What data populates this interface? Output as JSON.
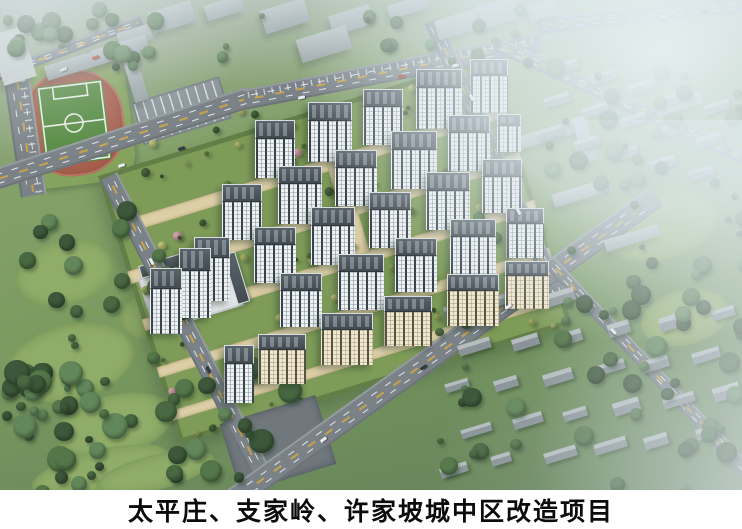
{
  "image": {
    "type": "aerial-architectural-rendering",
    "caption": "太平庄、支家岭、许家坡城中区改造项目"
  },
  "palette": {
    "caption_bg": "#ffffff",
    "caption_text": "#0b0b0b",
    "asphalt": "#7a8288",
    "lane_yellow": "#c8a24a",
    "lane_white": "#ebeff1",
    "site_green": "#7e9b58",
    "path_tan": "#dccfa6",
    "facade_white": "#eef1f2",
    "facade_cream": "#efe7ce",
    "window_dark": "#35404b",
    "roof_dark": "#434b52",
    "tree_dark": "#3c5739",
    "tree_light": "#8ba45f",
    "blossom_pink": "#d2a0ab",
    "pool_blue": "#4fb2cd",
    "track_red": "#a9614f",
    "pitch_green": "#568a41",
    "context_gray": "#99a3a7",
    "haze": "#e6eff2"
  }
}
